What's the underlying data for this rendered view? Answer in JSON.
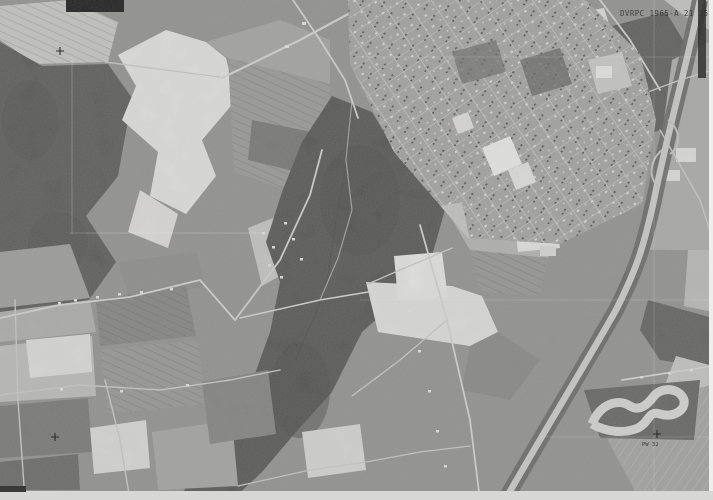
{
  "photo": {
    "annotation": "DVRPC 1965-A 21 352",
    "control_points": {
      "top_left": "",
      "bottom_left": "",
      "bottom_right": "PW 32"
    },
    "palette": {
      "base": "#8a8a88",
      "forest": "#4b4b49",
      "forest_dark": "#454543",
      "white_field": "#e3e3e1",
      "light_field": "#c4c4c2",
      "town": "#9d9d9b",
      "street": "#c8c8c6",
      "highway": "#c9c9c7",
      "margin_strip": "#d7d7d5"
    }
  }
}
